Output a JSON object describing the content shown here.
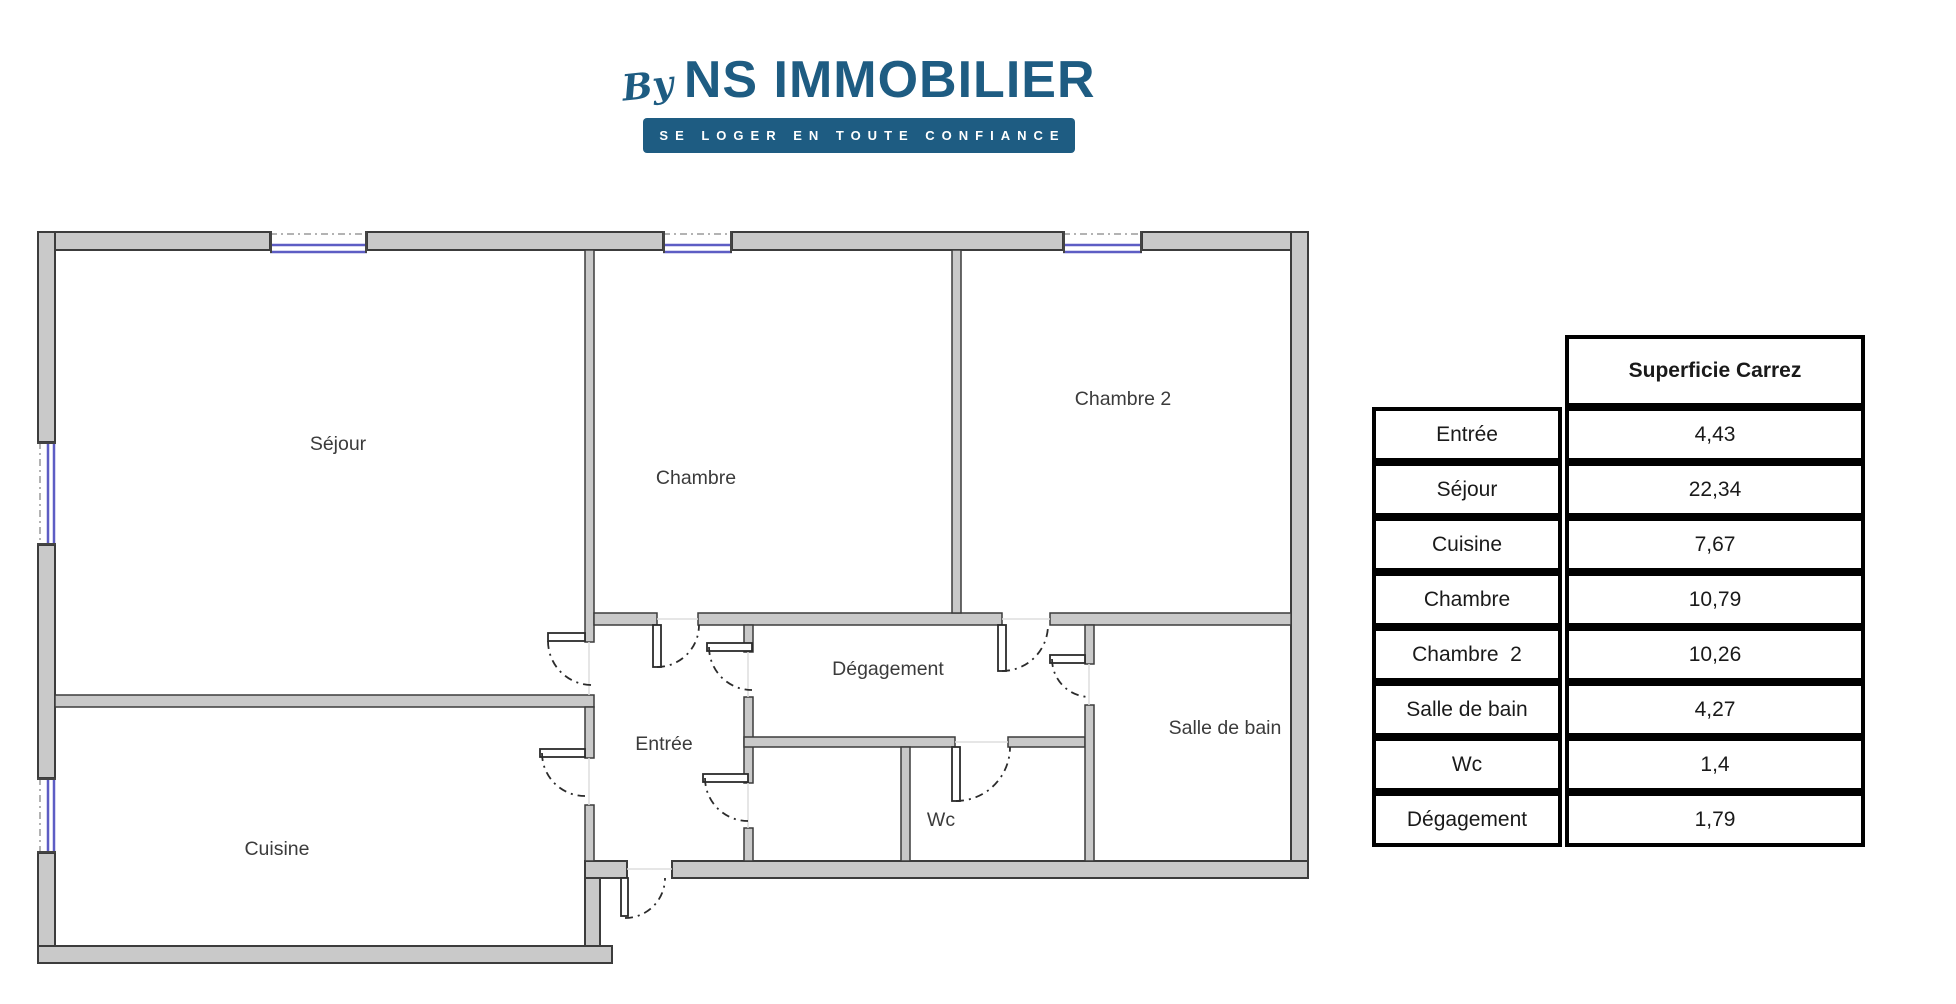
{
  "brand": {
    "by": "By",
    "name": "NS IMMOBILIER",
    "tagline": "SE LOGER EN TOUTE CONFIANCE",
    "color": "#1e5c82"
  },
  "floorplan": {
    "rooms": {
      "sejour": "Séjour",
      "chambre": "Chambre",
      "chambre2": "Chambre 2",
      "cuisine": "Cuisine",
      "entree": "Entrée",
      "degagement": "Dégagement",
      "wc": "Wc",
      "salle_de_bain": "Salle de bain"
    },
    "wall_color": "#c9c9c9",
    "window_color": "#5d5dc4"
  },
  "table": {
    "header": "Superficie Carrez",
    "rows": [
      {
        "room": "Entrée",
        "area": "4,43"
      },
      {
        "room": "Séjour",
        "area": "22,34"
      },
      {
        "room": "Cuisine",
        "area": "7,67"
      },
      {
        "room": "Chambre",
        "area": "10,79"
      },
      {
        "room": "Chambre  2",
        "area": "10,26"
      },
      {
        "room": "Salle de bain",
        "area": "4,27"
      },
      {
        "room": "Wc",
        "area": "1,4"
      },
      {
        "room": "Dégagement",
        "area": "1,79"
      }
    ]
  }
}
